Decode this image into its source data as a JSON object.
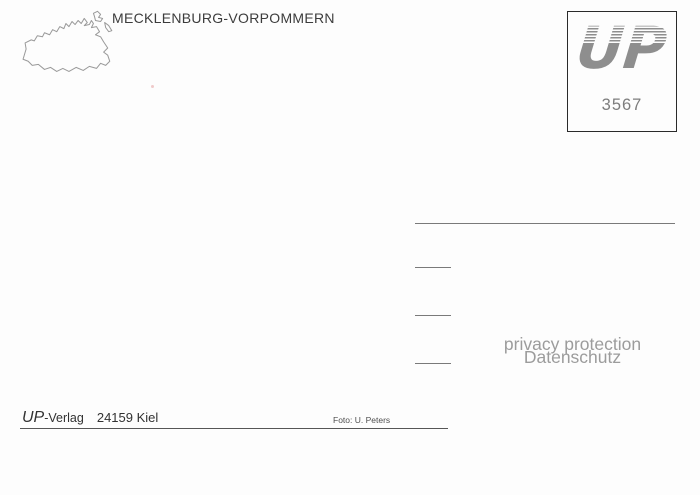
{
  "page": {
    "background": "#fdfdfd"
  },
  "header": {
    "region_title": "MECKLENBURG-VORPOMMERN",
    "map_name": "mecklenburg-vorpommern-outline"
  },
  "stamp_box": {
    "logo_text": "UP",
    "card_number": "3567",
    "logo_color": "#8e8e8e",
    "number_color": "#7d7d7d"
  },
  "address_area": {
    "long_line_count": 1,
    "short_line_count": 3,
    "line_color": "#7a7a7a"
  },
  "watermark": {
    "line1": "privacy protection",
    "line2": "Datenschutz",
    "color": "#9c9c9c"
  },
  "footer": {
    "publisher_logo": "UP",
    "publisher_name": "-Verlag",
    "publisher_location": "24159 Kiel",
    "photo_credit": "Foto: U. Peters"
  }
}
